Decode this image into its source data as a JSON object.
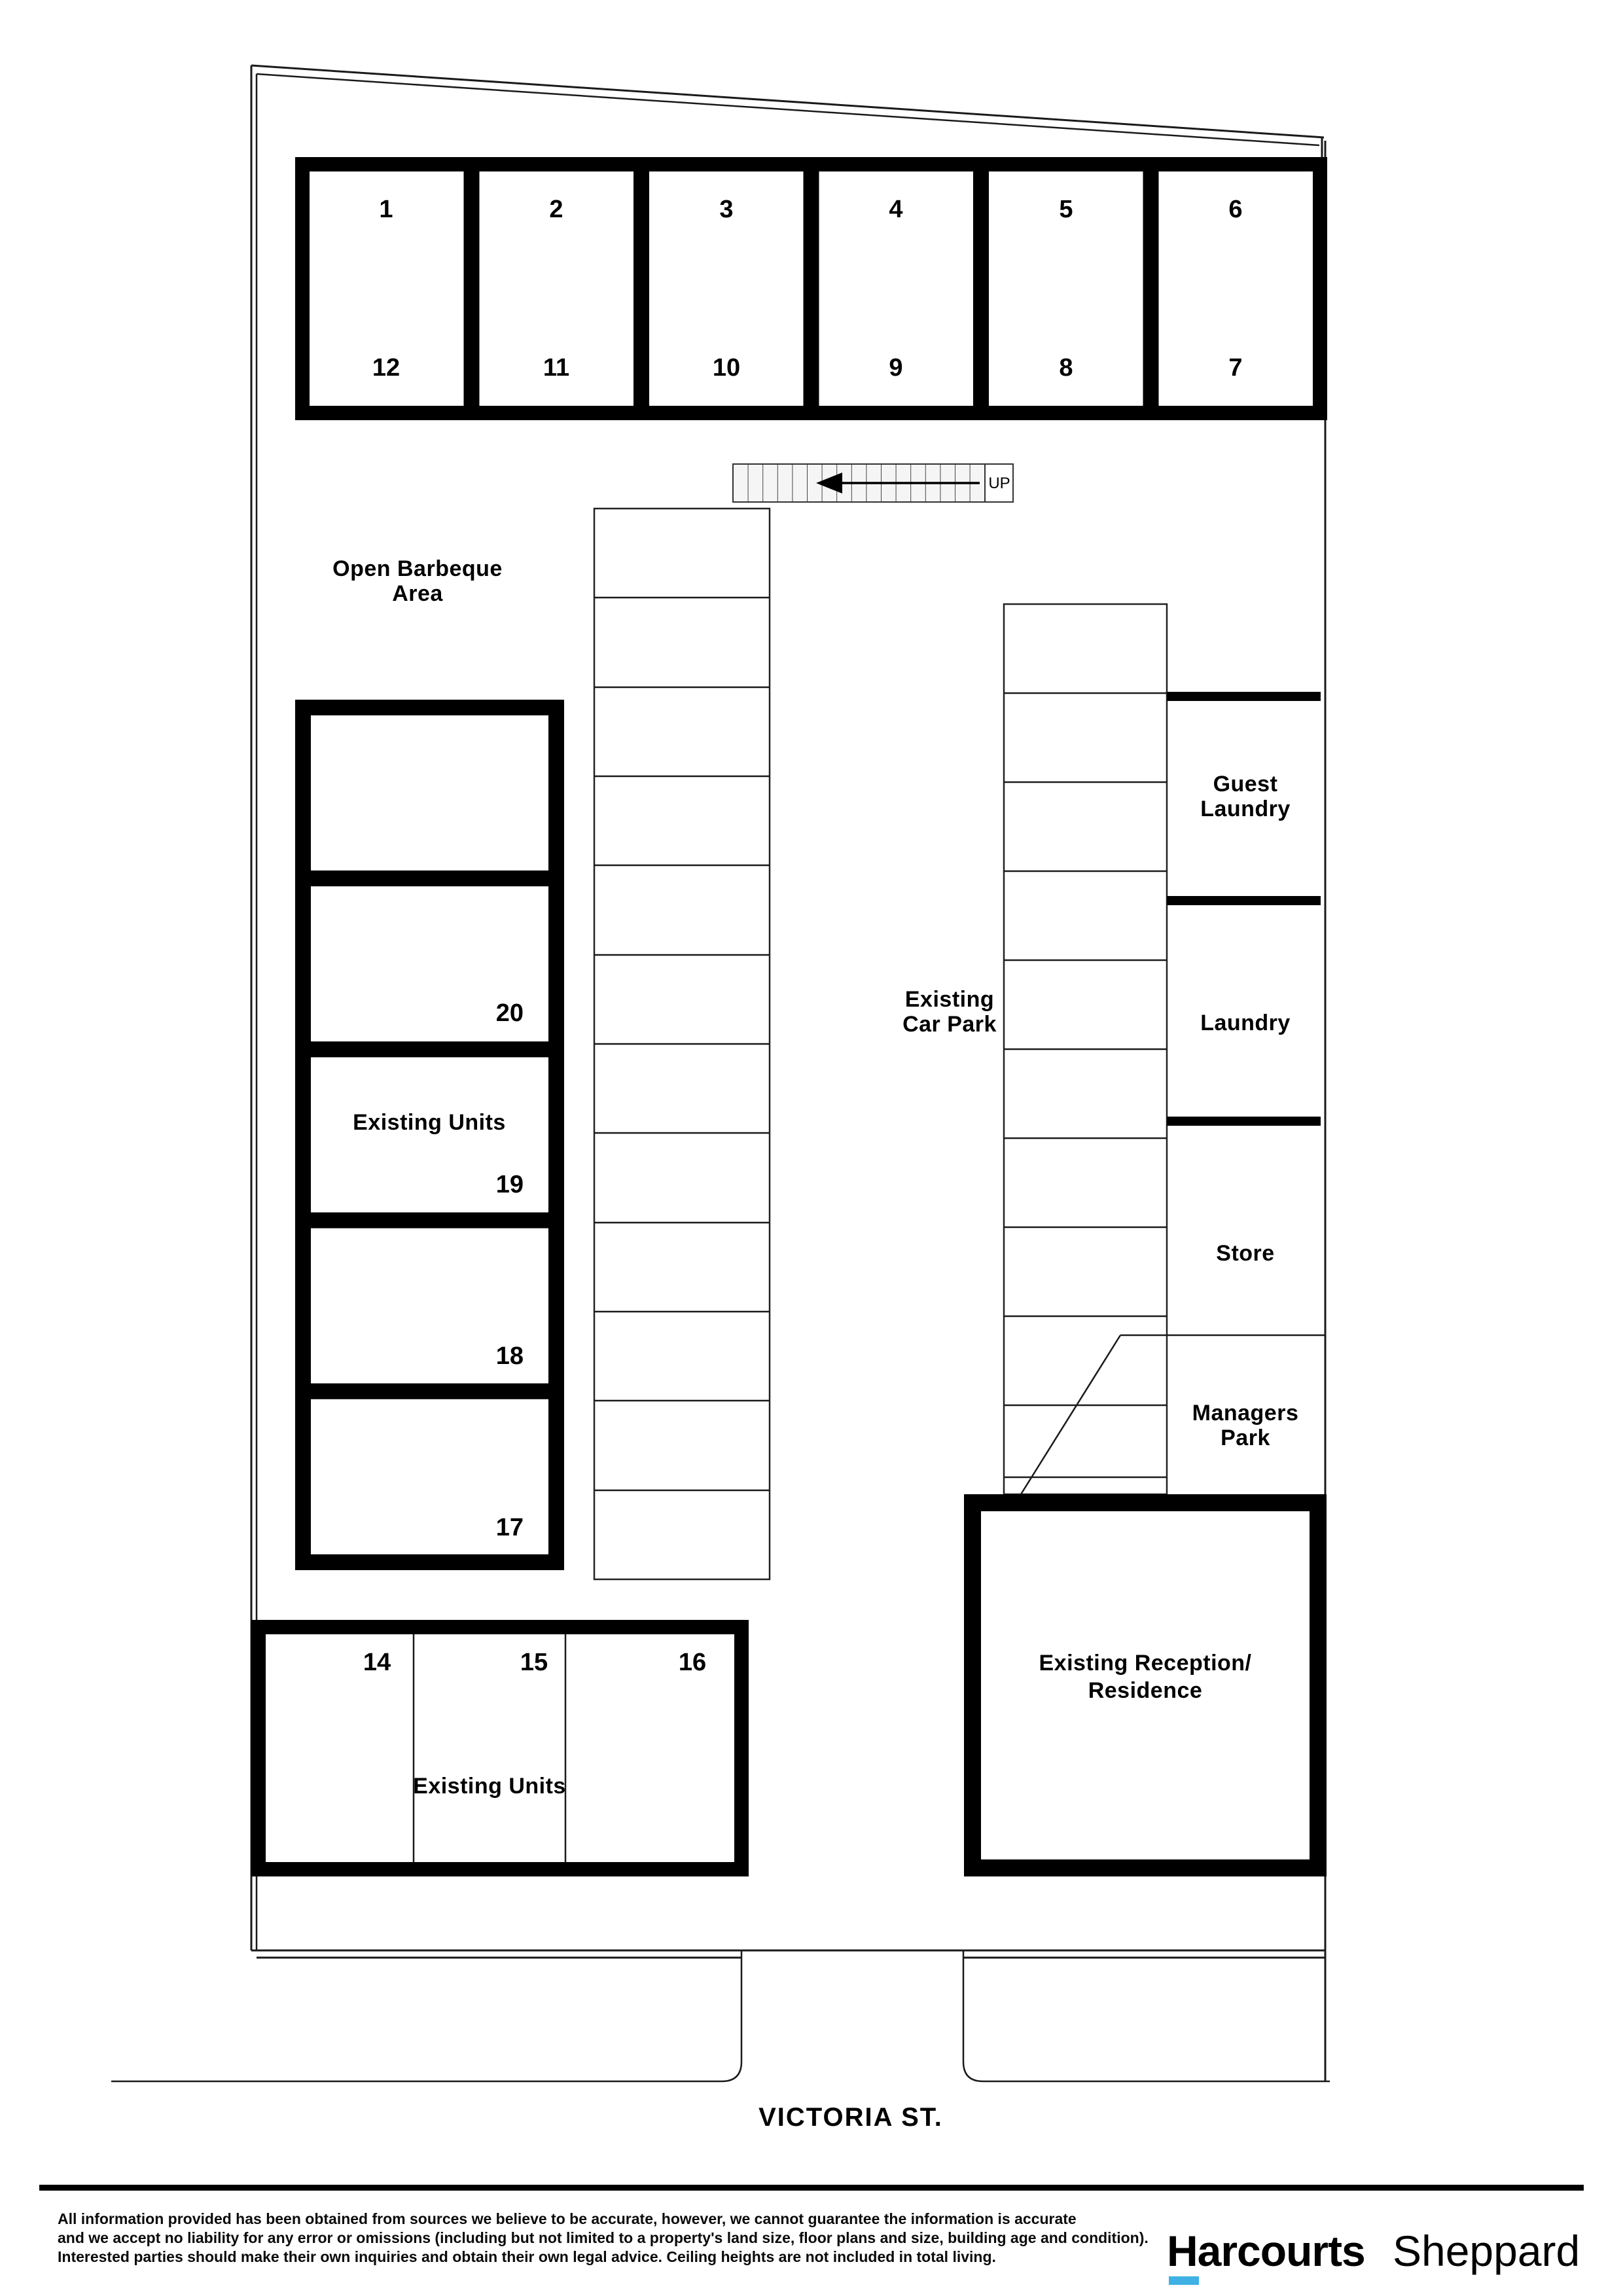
{
  "plan": {
    "top_units": {
      "top_numbers": [
        "1",
        "2",
        "3",
        "4",
        "5",
        "6"
      ],
      "bottom_numbers": [
        "12",
        "11",
        "10",
        "9",
        "8",
        "7"
      ]
    },
    "stairs": {
      "up_label": "UP"
    },
    "barbeque": {
      "line1": "Open Barbeque",
      "line2": "Area"
    },
    "left_units": {
      "label": "Existing Units",
      "numbers": [
        "20",
        "19",
        "18",
        "17"
      ]
    },
    "car_park": {
      "line1": "Existing",
      "line2": "Car Park"
    },
    "services": {
      "guest_laundry_line1": "Guest",
      "guest_laundry_line2": "Laundry",
      "laundry": "Laundry",
      "store": "Store",
      "managers_line1": "Managers",
      "managers_line2": "Park"
    },
    "reception": {
      "line1": "Existing Reception/",
      "line2": "Residence"
    },
    "bottom_units": {
      "label": "Existing Units",
      "numbers": [
        "14",
        "15",
        "16"
      ]
    },
    "street_name": "VICTORIA ST."
  },
  "footer": {
    "disclaimer": {
      "line1": "All information provided has been obtained from sources we believe to be accurate, however, we cannot guarantee the information is accurate",
      "line2": "and we accept no liability for any error or omissions (including but not limited to a property's land size, floor plans and size, building age and condition).",
      "line3": "Interested parties should make their own inquiries and obtain their own legal advice. Ceiling heights are not included in total living."
    },
    "logo": {
      "brand": "Harcourts",
      "office": "Sheppard",
      "brand_color": "#13294b",
      "office_color": "#3fb1e5",
      "underline_color": "#3fb1e5"
    }
  }
}
